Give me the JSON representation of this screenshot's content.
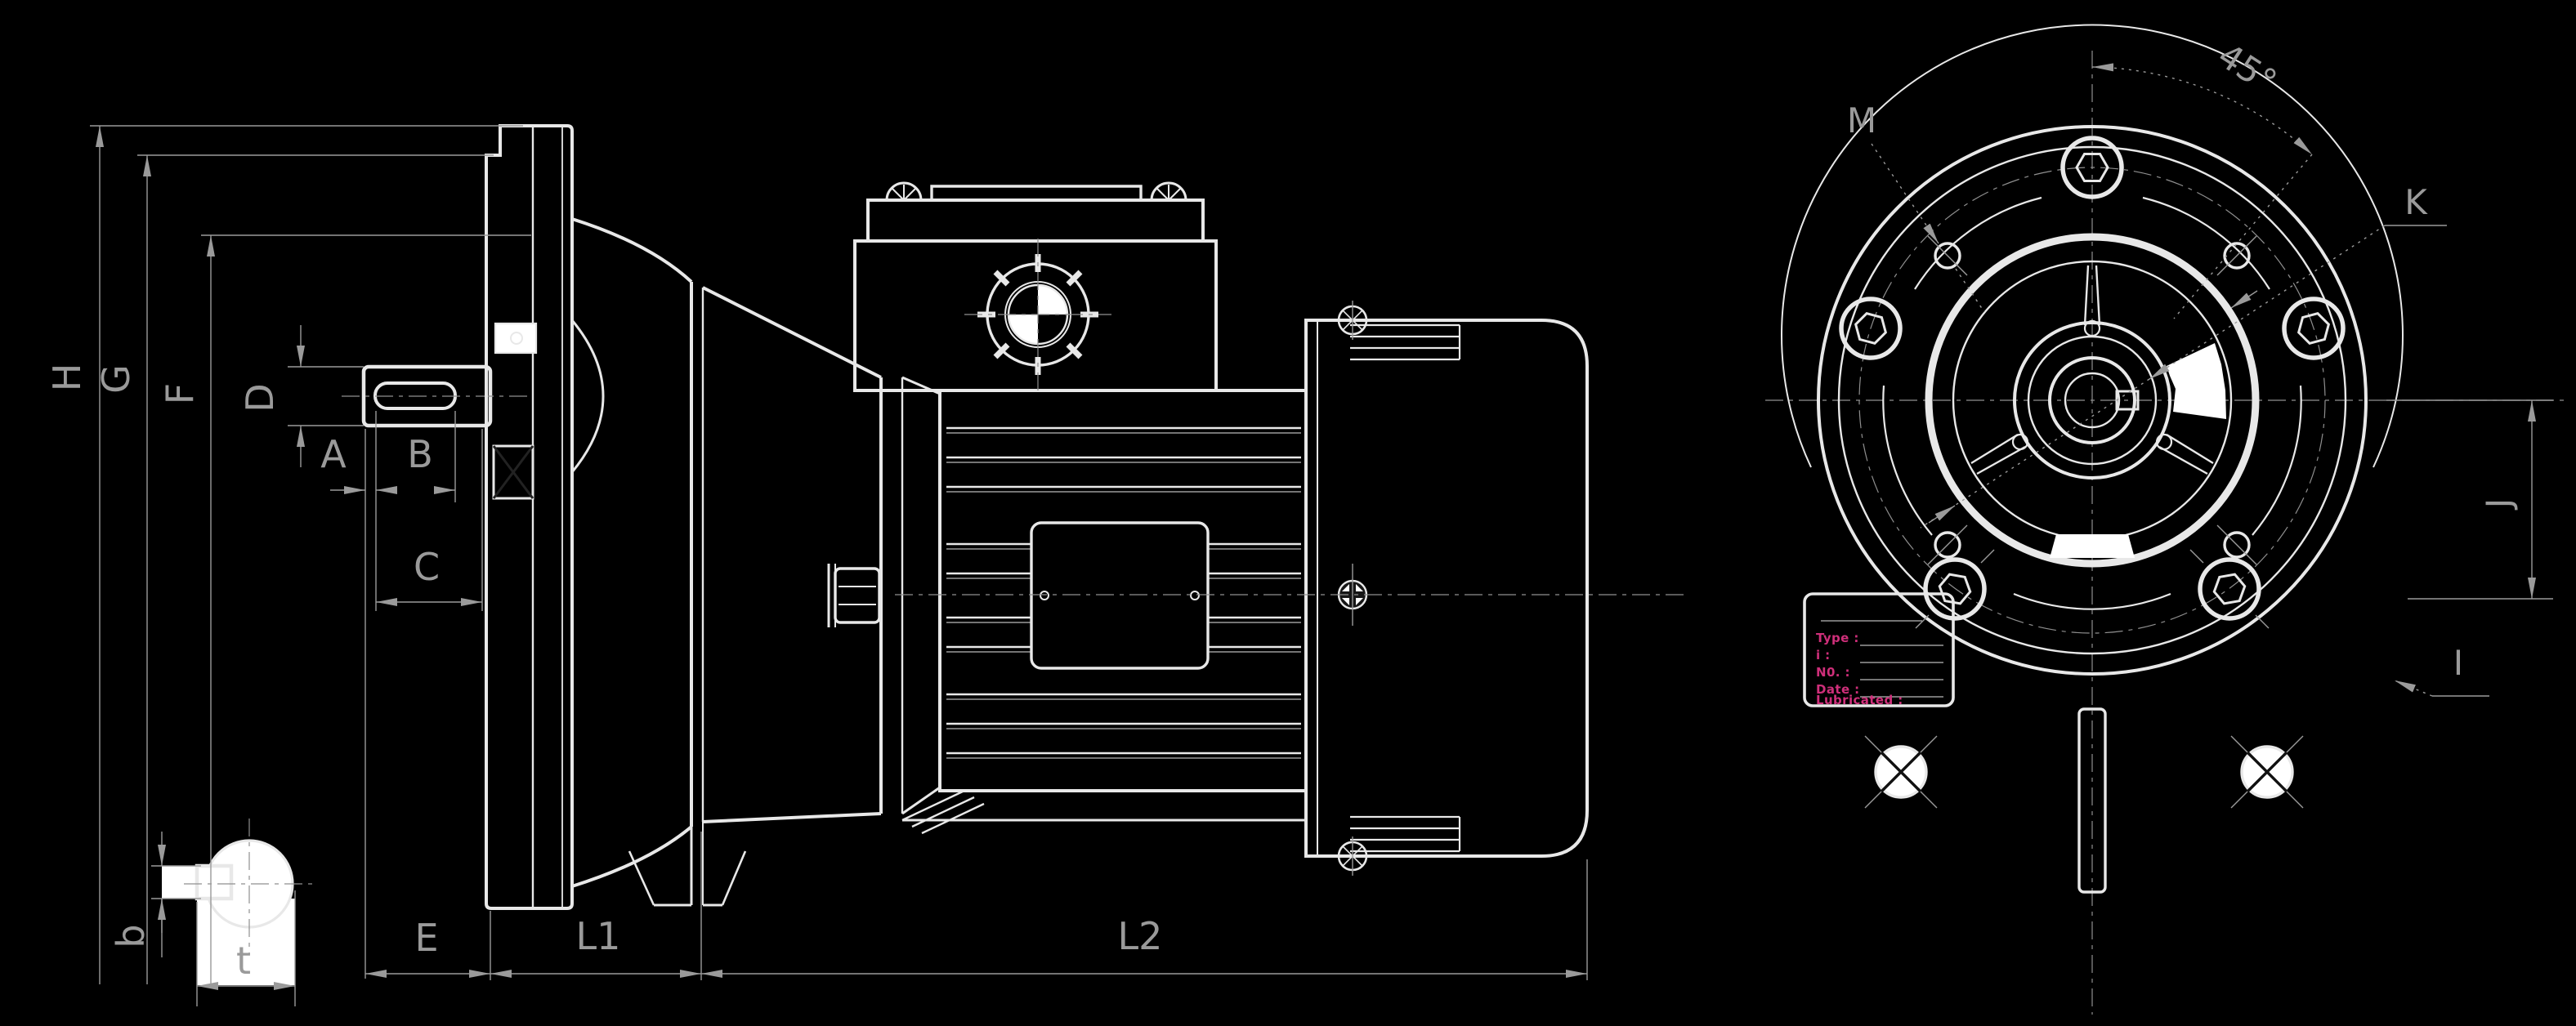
{
  "drawing": {
    "title": "gearmotor-dimension-drawing",
    "labels": {
      "H": "H",
      "G": "G",
      "F": "F",
      "D": "D",
      "A": "A",
      "B": "B",
      "C": "C",
      "E": "E",
      "L1": "L1",
      "L2": "L2",
      "b": "b",
      "t": "t"
    },
    "flange_labels": {
      "M": "M",
      "K": "K",
      "J": "J",
      "I": "I",
      "angle_45": "45°"
    },
    "nameplate": {
      "fields": [
        "Type :",
        "i :",
        "N0. :",
        "Date :",
        "Lubricated :"
      ]
    },
    "colors": {
      "background": "#000000",
      "line": "#e8e8e8",
      "dimension": "#9a9a9a",
      "nameplate_text": "#cf2f7a"
    }
  }
}
